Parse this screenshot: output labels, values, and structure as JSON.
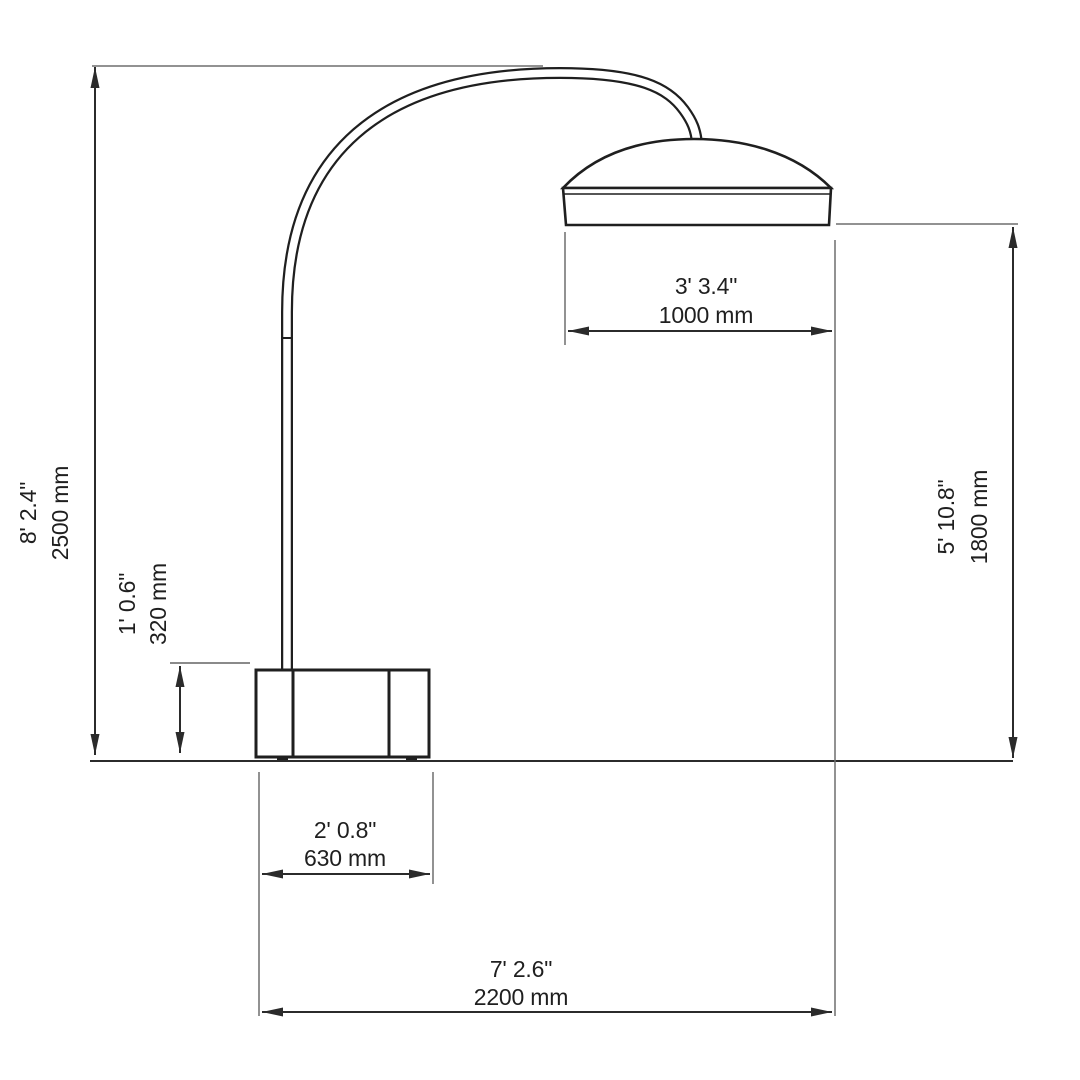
{
  "document": {
    "type": "technical-dimension-drawing",
    "subject": "arc floor lamp, front elevation"
  },
  "colors": {
    "background": "#ffffff",
    "drawing_line": "#1f1f1f",
    "dimension_line": "#2b2b2b",
    "extension_line": "#6e6e6e",
    "text": "#1f1f1f"
  },
  "dimensions": {
    "total_height": {
      "imperial": "8' 2.4\"",
      "metric": "2500 mm"
    },
    "base_height": {
      "imperial": "1' 0.6\"",
      "metric": "320 mm"
    },
    "clearance_height": {
      "imperial": "5' 10.8\"",
      "metric": "1800 mm"
    },
    "shade_width": {
      "imperial": "3' 3.4\"",
      "metric": "1000 mm"
    },
    "base_width": {
      "imperial": "2' 0.8\"",
      "metric": "630 mm"
    },
    "total_width": {
      "imperial": "7' 2.6\"",
      "metric": "2200 mm"
    }
  }
}
